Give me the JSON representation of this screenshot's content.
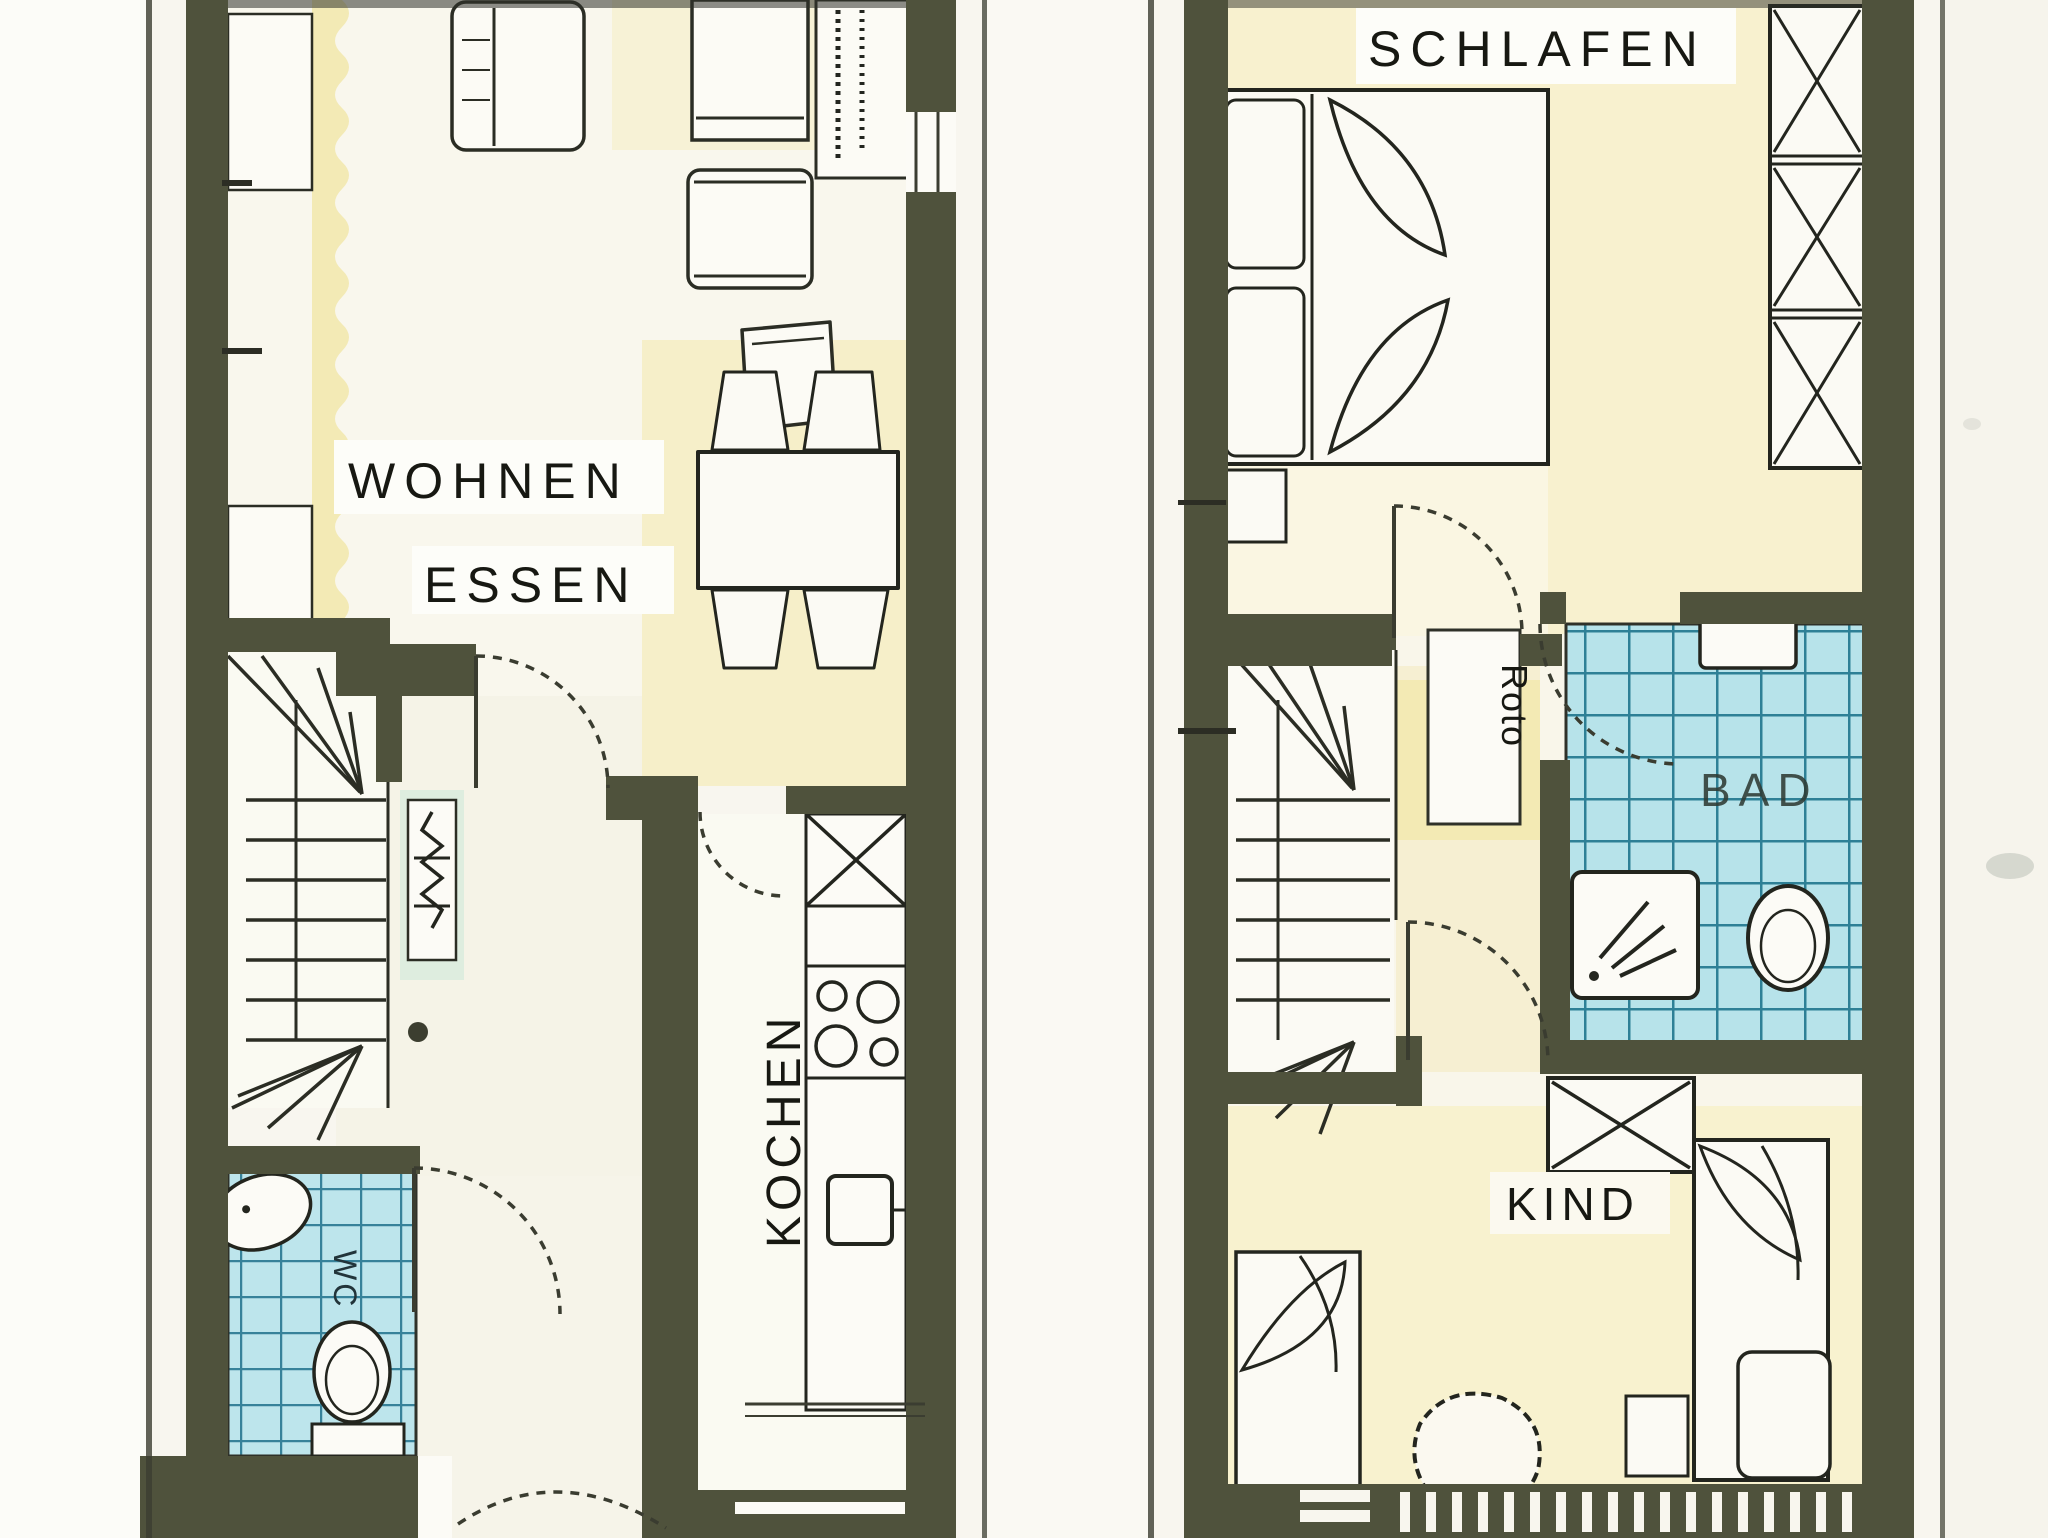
{
  "floorplan": {
    "ground_floor": {
      "rooms": {
        "living": "WOHNEN",
        "dining": "ESSEN",
        "kitchen": "KOCHEN",
        "wc": "WC"
      }
    },
    "upper_floor": {
      "rooms": {
        "bedroom": "SCHLAFEN",
        "bath": "BAD",
        "child": "KIND"
      },
      "annotations": {
        "roof_window": "Roto"
      }
    },
    "colors": {
      "wall": "#4f523c",
      "ink": "#23251e",
      "paper": "#f8f6ef",
      "floor_tint": "#f6efc9",
      "tile": "#b7e3ea",
      "tile_grid": "#2e8096"
    }
  }
}
